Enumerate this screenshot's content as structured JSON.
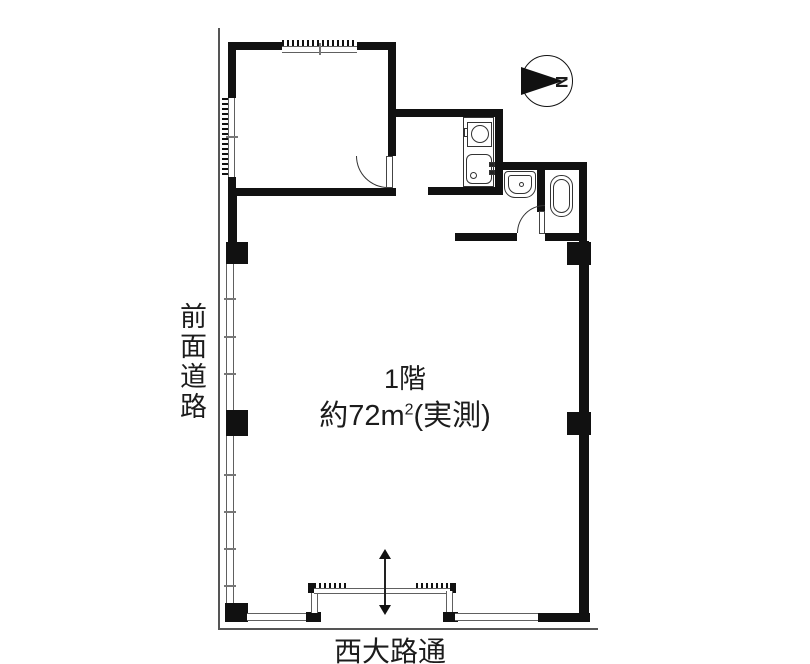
{
  "plan": {
    "floor_label": "1階",
    "area_label_parts": {
      "prefix": "約72m",
      "sup": "2",
      "suffix": "(実測)"
    },
    "road_left_label": "前面道路",
    "road_bottom_label": "西大路通",
    "compass_letter": "N"
  },
  "colors": {
    "wall": "#111111",
    "thin_line": "#606060",
    "road_line": "#555555",
    "background": "#ffffff"
  },
  "icons": {
    "compass": "north-arrow-icon",
    "kitchen_stove": "stove-icon",
    "kitchen_sink": "kitchen-sink-icon",
    "washbasin": "washbasin-icon",
    "bathtub": "bathtub-icon",
    "entrance": "entrance-arrow-icon"
  }
}
